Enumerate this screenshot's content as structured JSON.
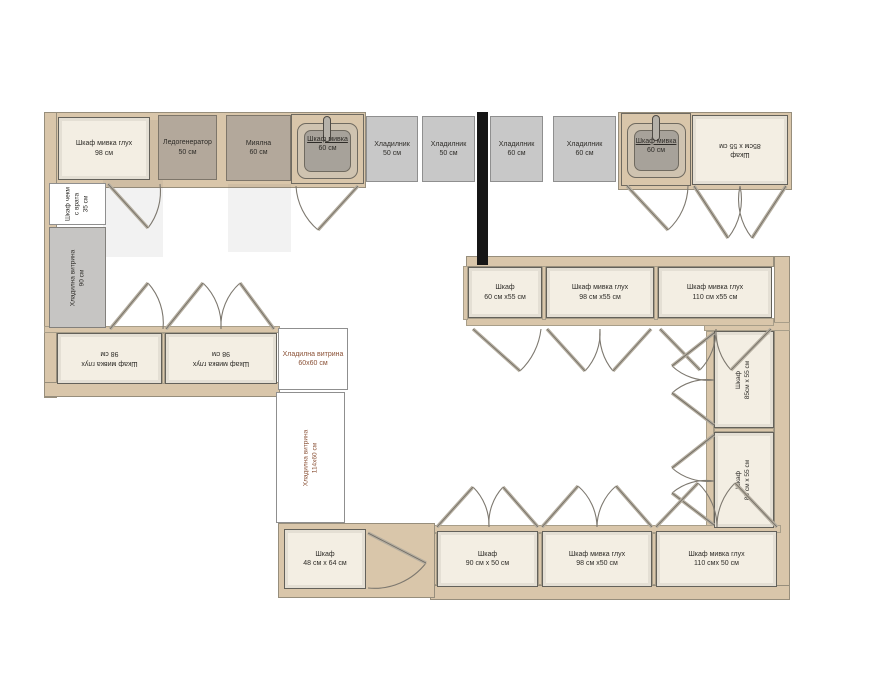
{
  "colors": {
    "wall": "#d9c6aa",
    "cabinet": "#f3eee3",
    "appliance": "#b3a89b",
    "fridge": "#c8c8c8",
    "divider": "#161616",
    "vitrine_text": "#8a5136"
  },
  "labels": {
    "sink98_top": {
      "l1": "Шкаф мивка глух",
      "l2": "98 см"
    },
    "ice_maker": {
      "l1": "Ледогенератор",
      "l2": "50 см"
    },
    "dishwasher": {
      "l1": "Миялна",
      "l2": "60 см"
    },
    "sink_left": {
      "l1": "Шкаф мивка",
      "l2": "60 см"
    },
    "fridge50_1": {
      "l1": "Хладилник",
      "l2": "50 см"
    },
    "fridge50_2": {
      "l1": "Хладилник",
      "l2": "50 см"
    },
    "fridge60_1": {
      "l1": "Хладилник",
      "l2": "60 см"
    },
    "fridge60_2": {
      "l1": "Хладилник",
      "l2": "60 см"
    },
    "sink_right": {
      "l1": "Шкаф мивка",
      "l2": "60 см"
    },
    "corner85": {
      "l1": "Шкаф",
      "l2": "85см х 55 см"
    },
    "drawer35": {
      "l1": "Шкаф чекм",
      "l2": "с врата",
      "l3": "35 см"
    },
    "vitrine90": {
      "l1": "Хладилна витрина",
      "l2": "90 см"
    },
    "base98_left1": {
      "l1": "Шкаф мивка глух",
      "l2": "98 см"
    },
    "base98_left2": {
      "l1": "Шкаф мивка глух",
      "l2": "98 см"
    },
    "vitrine60": {
      "l1": "Хладилна витрина",
      "l2": "60х60 см"
    },
    "vitrine114": {
      "l1": "Хладилна витрина",
      "l2": "114х60 см"
    },
    "island60": {
      "l1": "Шкаф",
      "l2": "60 см х55 см"
    },
    "island98": {
      "l1": "Шкаф мивка глух",
      "l2": "98 см х55 см"
    },
    "island110": {
      "l1": "Шкаф мивка глух",
      "l2": "110 см х55 см"
    },
    "right85_1": {
      "l1": "Шкаф",
      "l2": "85см х 55 см"
    },
    "right85_2": {
      "l1": "Шкаф",
      "l2": "85 см х 55 см"
    },
    "bottom90": {
      "l1": "Шкаф",
      "l2": "90 см х 50 см"
    },
    "bottom98": {
      "l1": "Шкаф мивка глух",
      "l2": "98 см х50 см"
    },
    "bottom110": {
      "l1": "Шкаф мивка глух",
      "l2": "110 смх 50 см"
    },
    "cab48": {
      "l1": "Шкаф",
      "l2": "48 см х 64 см"
    }
  }
}
